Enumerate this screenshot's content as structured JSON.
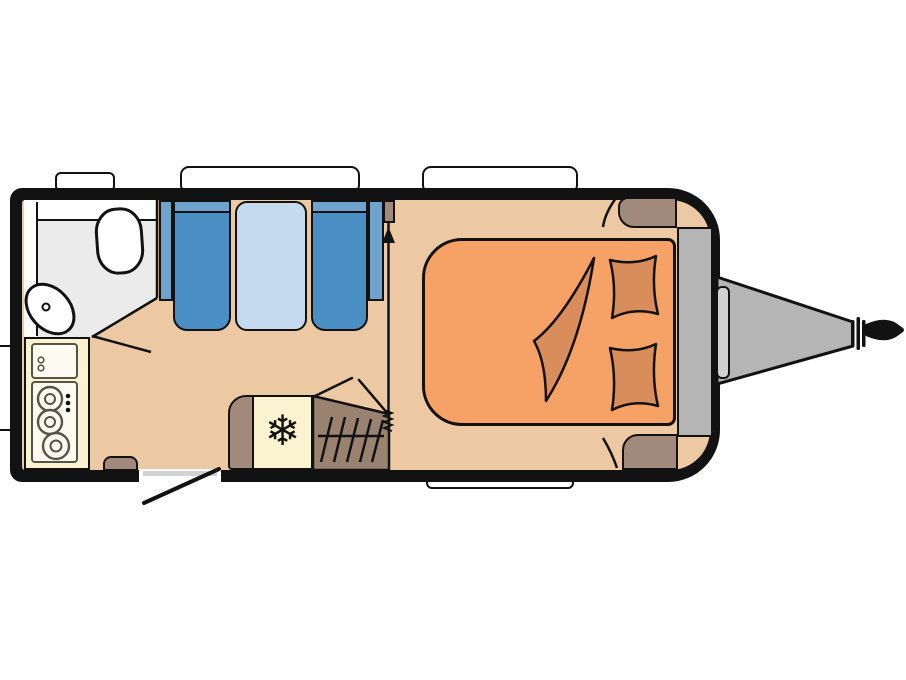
{
  "icons": {
    "snowflake": "❄"
  },
  "colors": {
    "background": "#ffffff",
    "outline": "#121212",
    "floor": "#ecc9a2",
    "bathroom": "#ebebeb",
    "fixture": "#ffffff",
    "counter": "#fbf3cf",
    "panel": "#fdfbf0",
    "panel_stroke": "#55544a",
    "seat": "#4a8fc3",
    "seat_back": "#6fa3cc",
    "table": "#c5daee",
    "bed": "#f6a165",
    "bedding": "#d98d5b",
    "cabinet": "#a18a7c",
    "heater": "#9a8271",
    "metal": "#b5b5b5",
    "metal_light": "#d2d2d2",
    "window": "#ffffff"
  }
}
